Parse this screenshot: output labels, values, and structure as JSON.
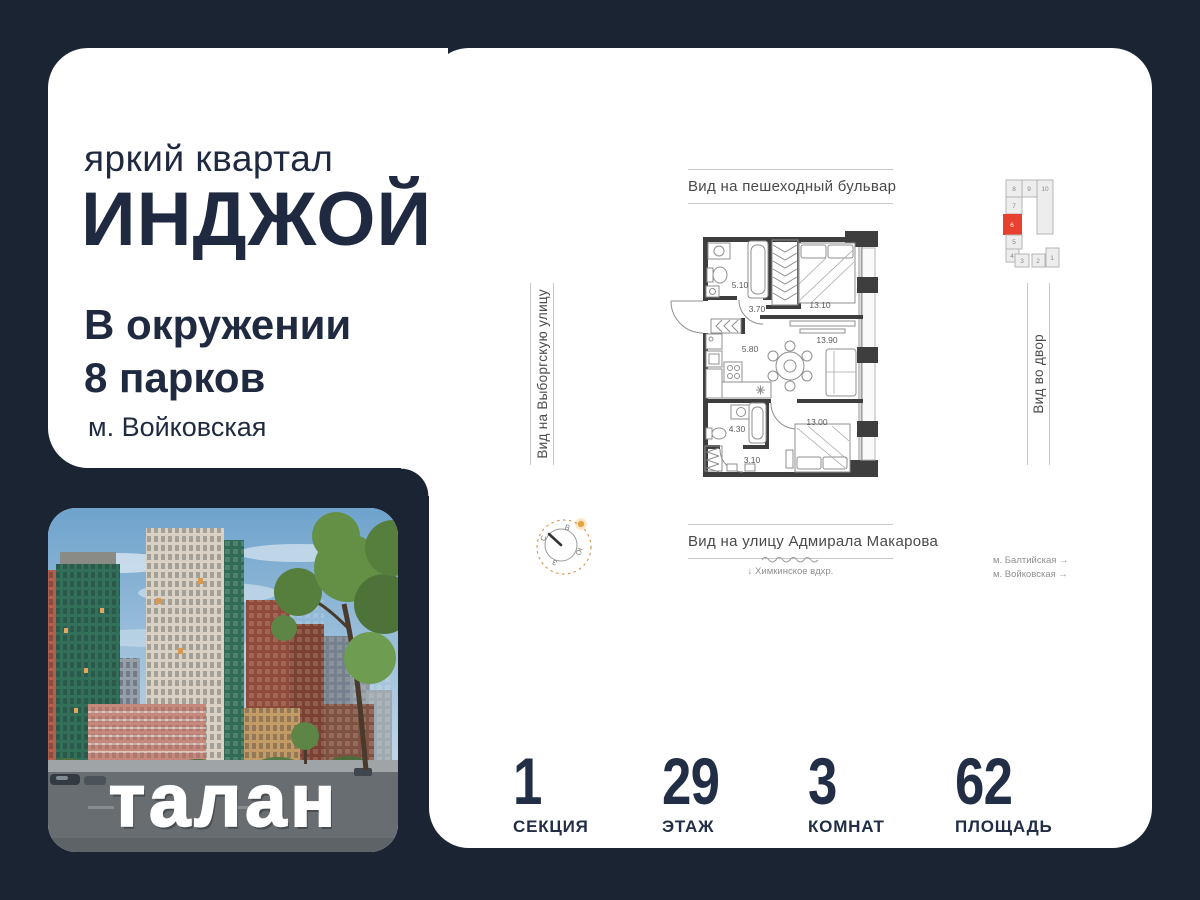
{
  "brand": {
    "tagline": "яркий квартал",
    "name": "ИНДЖОЙ",
    "usp_line1": "В окружении",
    "usp_line2": "8 парков",
    "metro": "м. Войковская",
    "developer_logo": "талан"
  },
  "plan": {
    "view_top": "Вид на пешеходный бульвар",
    "view_left": "Вид на Выборгскую улицу",
    "view_right": "Вид во двор",
    "view_bottom": "Вид на улицу Адмирала Макарова",
    "reservoir_note": "↓  Химкинское вдхр.",
    "metro_note1": "м. Балтийская  →",
    "metro_note2": "м. Войковская  →",
    "rooms": [
      {
        "name": "bathroom-1",
        "area": "5.10"
      },
      {
        "name": "hallway-1",
        "area": "3.70"
      },
      {
        "name": "bedroom-1",
        "area": "13.10"
      },
      {
        "name": "kitchen",
        "area": "5.80"
      },
      {
        "name": "living-room",
        "area": "13.90"
      },
      {
        "name": "bathroom-2",
        "area": "4.30"
      },
      {
        "name": "hallway-2",
        "area": "3.10"
      },
      {
        "name": "bedroom-2",
        "area": "13.00"
      }
    ],
    "site_sections": [
      "8",
      "9",
      "10",
      "7",
      "6",
      "5",
      "4",
      "3",
      "2",
      "1"
    ],
    "highlighted_section": "6",
    "compass": {
      "n": "С",
      "e": "В",
      "s": "Ю",
      "w": "З"
    }
  },
  "stats": [
    {
      "value": "1",
      "label": "СЕКЦИЯ"
    },
    {
      "value": "29",
      "label": "ЭТАЖ"
    },
    {
      "value": "3",
      "label": "КОМНАТ"
    },
    {
      "value": "62",
      "label": "ПЛОЩАДЬ"
    }
  ],
  "colors": {
    "background": "#1a2433",
    "card": "#ffffff",
    "text": "#1f2a40",
    "accent_red": "#e8402f",
    "compass_orange": "#e2a150"
  }
}
